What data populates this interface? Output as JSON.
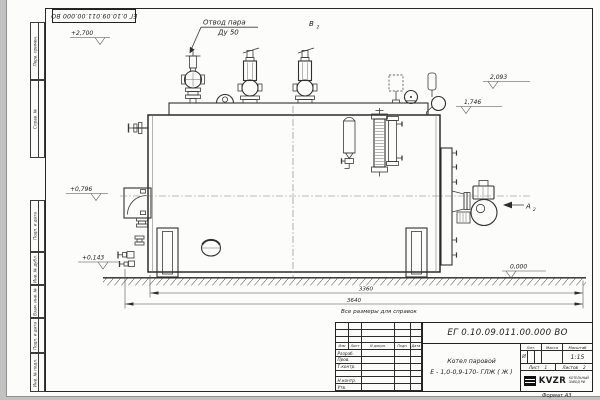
{
  "sheet": {
    "corner_stamp": "ЕГ 0.10.09.011.00.000  ВО",
    "reference_note": "Все размеры для справок",
    "format_note": "Формат А3",
    "margin_columns": [
      "Перв. примен.",
      "Справ. №",
      "Подп. и дата",
      "Инв. № дубл.",
      "Взам. инв. №",
      "Подп. и дата",
      "Инв. № подл."
    ]
  },
  "drawing": {
    "callout_steam_line1": "Отвод пара",
    "callout_steam_line2": "Ду 50",
    "view_b": "В",
    "view_b_sheet": "2",
    "view_a": "А",
    "view_a_sheet": "2",
    "elev_2700": "+2,700",
    "elev_2093": "2,093",
    "elev_1746": "1,746",
    "elev_0796": "+0,796",
    "elev_0143": "+0,143",
    "elev_0000": "0,000",
    "dim_inner": "3360",
    "dim_overall": "3640"
  },
  "title_block": {
    "doc_number": "ЕГ 0.10.09.011.00.000  ВО",
    "product_line1": "Котел паровой",
    "product_line2": "Е - 1,0-0,9-170- ГЛЖ ( Ж )",
    "header": [
      "Изм",
      "Лист",
      "N докум.",
      "Подп.",
      "Дата"
    ],
    "roles": [
      "Разраб.",
      "Пров.",
      "Т.контр.",
      "",
      "Н.контр.",
      "Утв."
    ],
    "lit_header": "Лит.",
    "mass_header": "Масса",
    "scale_header": "Масштаб",
    "lit_value": "И",
    "scale_value": "1:15",
    "sheet_label": "Лист",
    "sheet_value": "1",
    "sheets_label": "Листов",
    "sheets_value": "2",
    "brand": "KVZR",
    "brand_line1": "КОТЕЛЬНЫЙ",
    "brand_line2": "ЗАВОД РФ"
  }
}
